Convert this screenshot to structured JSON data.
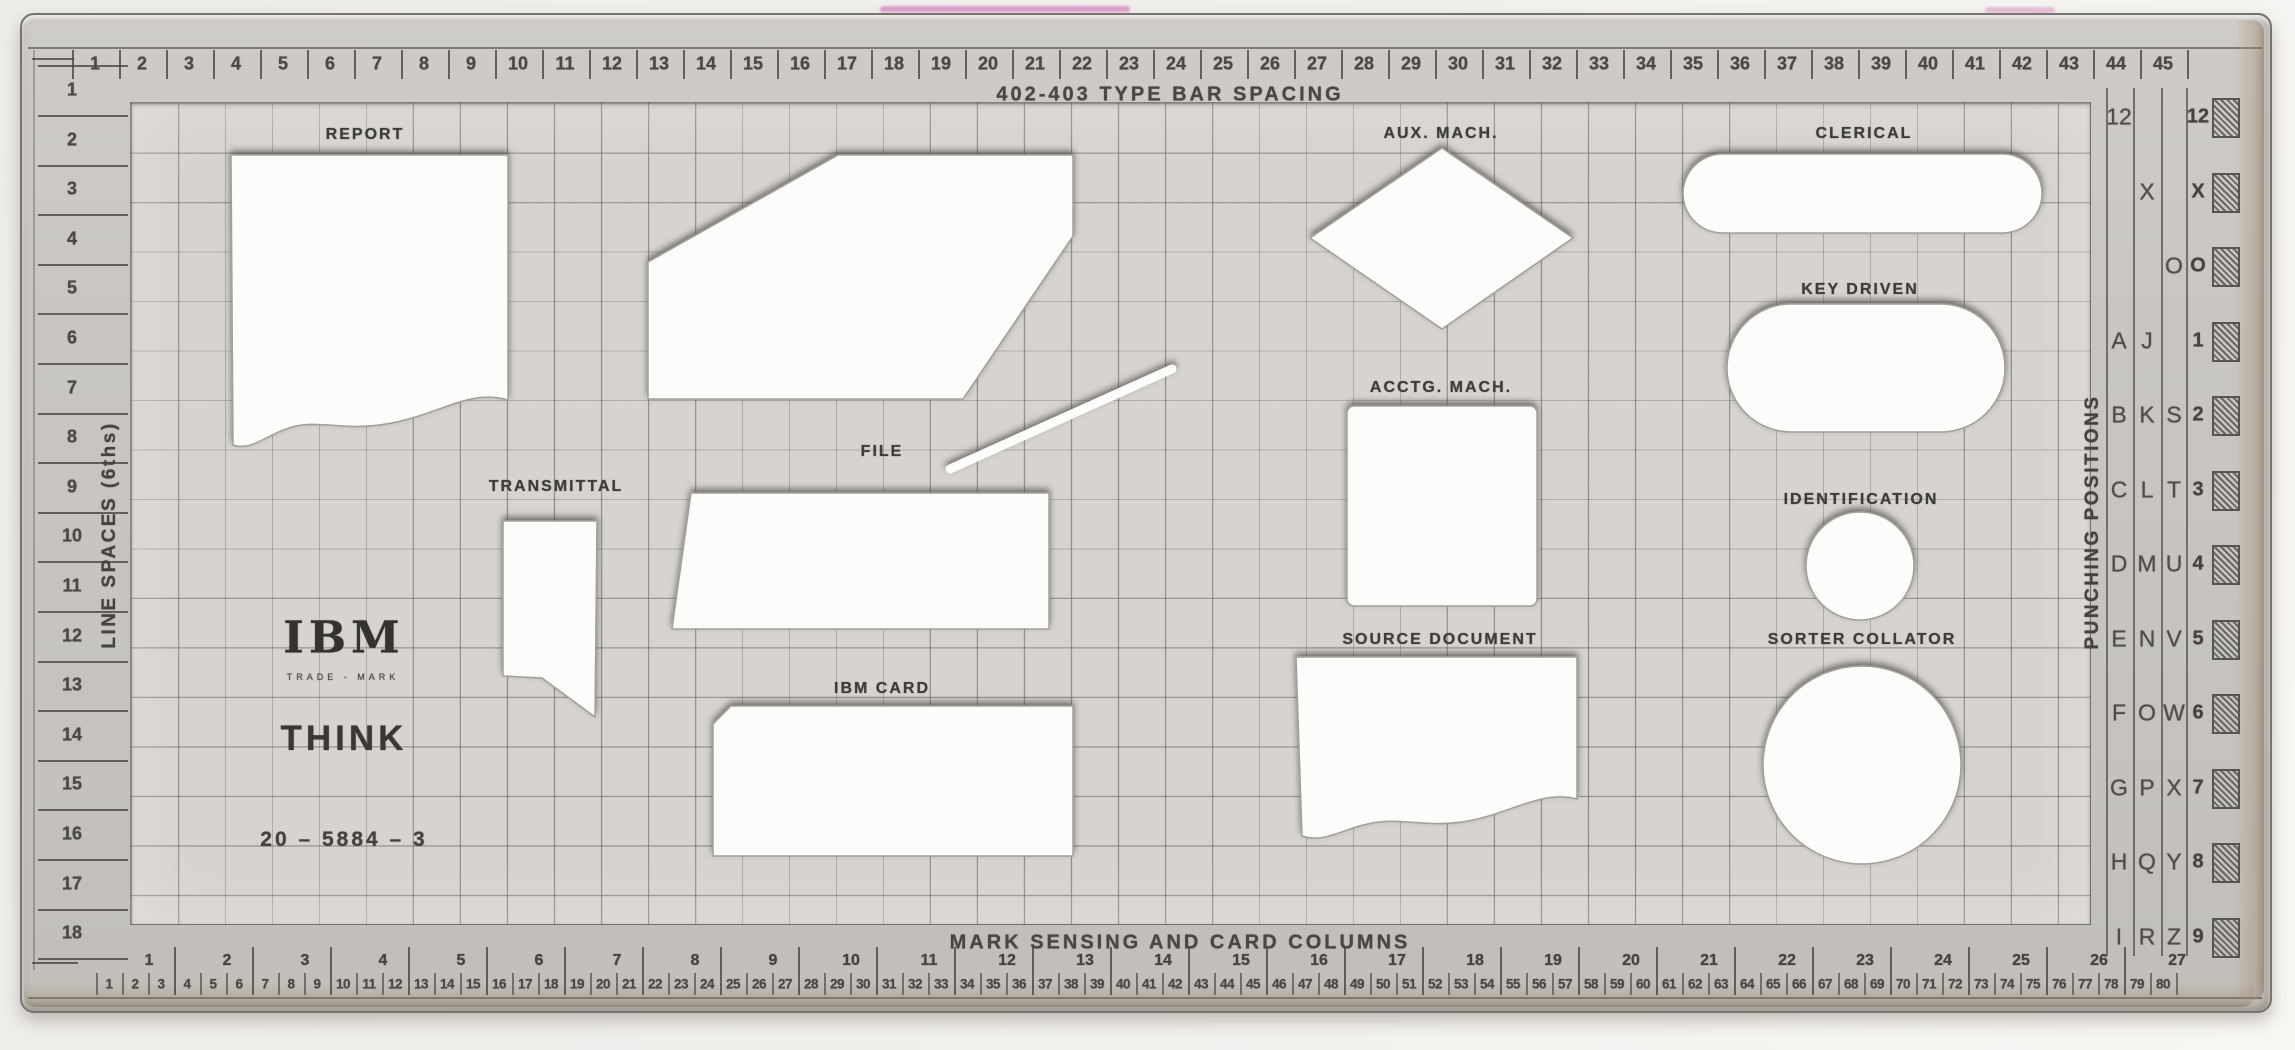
{
  "titles": {
    "top": "402-403 TYPE BAR SPACING",
    "bottom": "MARK SENSING AND CARD COLUMNS",
    "left": "LINE SPACES (6ths)",
    "right": "PUNCHING POSITIONS"
  },
  "brand": {
    "logo": "IBM",
    "trademark": "TRADE - MARK",
    "slogan": "THINK",
    "part_number": "20 – 5884 – 3"
  },
  "top_ruler": {
    "numbers": [
      1,
      2,
      3,
      4,
      5,
      6,
      7,
      8,
      9,
      10,
      11,
      12,
      13,
      14,
      15,
      16,
      17,
      18,
      19,
      20,
      21,
      22,
      23,
      24,
      25,
      26,
      27,
      28,
      29,
      30,
      31,
      32,
      33,
      34,
      35,
      36,
      37,
      38,
      39,
      40,
      41,
      42,
      43,
      44,
      45
    ]
  },
  "left_ruler": {
    "numbers": [
      1,
      2,
      3,
      4,
      5,
      6,
      7,
      8,
      9,
      10,
      11,
      12,
      13,
      14,
      15,
      16,
      17,
      18
    ]
  },
  "bottom_ruler": {
    "mark_numbers": [
      1,
      2,
      3,
      4,
      5,
      6,
      7,
      8,
      9,
      10,
      11,
      12,
      13,
      14,
      15,
      16,
      17,
      18,
      19,
      20,
      21,
      22,
      23,
      24,
      25,
      26,
      27
    ],
    "card_numbers": [
      1,
      2,
      3,
      4,
      5,
      6,
      7,
      8,
      9,
      10,
      11,
      12,
      13,
      14,
      15,
      16,
      17,
      18,
      19,
      20,
      21,
      22,
      23,
      24,
      25,
      26,
      27,
      28,
      29,
      30,
      31,
      32,
      33,
      34,
      35,
      36,
      37,
      38,
      39,
      40,
      41,
      42,
      43,
      44,
      45,
      46,
      47,
      48,
      49,
      50,
      51,
      52,
      53,
      54,
      55,
      56,
      57,
      58,
      59,
      60,
      61,
      62,
      63,
      64,
      65,
      66,
      67,
      68,
      69,
      70,
      71,
      72,
      73,
      74,
      75,
      76,
      77,
      78,
      79,
      80
    ]
  },
  "punching_positions": {
    "rows": [
      [
        "12",
        "",
        "",
        "12"
      ],
      [
        "",
        "X",
        "",
        "X"
      ],
      [
        "",
        "",
        "O",
        "O"
      ],
      [
        "A",
        "J",
        "",
        "1"
      ],
      [
        "B",
        "K",
        "S",
        "2"
      ],
      [
        "C",
        "L",
        "T",
        "3"
      ],
      [
        "D",
        "M",
        "U",
        "4"
      ],
      [
        "E",
        "N",
        "V",
        "5"
      ],
      [
        "F",
        "O",
        "W",
        "6"
      ],
      [
        "G",
        "P",
        "X",
        "7"
      ],
      [
        "H",
        "Q",
        "Y",
        "8"
      ],
      [
        "I",
        "R",
        "Z",
        "9"
      ]
    ]
  },
  "shapes": [
    {
      "label": "REPORT"
    },
    {
      "label": "FILE"
    },
    {
      "label": "TRANSMITTAL"
    },
    {
      "label": "IBM CARD"
    },
    {
      "label": "AUX. MACH."
    },
    {
      "label": "ACCTG. MACH."
    },
    {
      "label": "SOURCE DOCUMENT"
    },
    {
      "label": "CLERICAL"
    },
    {
      "label": "KEY DRIVEN"
    },
    {
      "label": "IDENTIFICATION"
    },
    {
      "label": "SORTER COLLATOR"
    }
  ],
  "colors": {
    "plastic": "#c8c5c0",
    "grid_bg": "#d7d4cf",
    "grid_line": "#5a5854",
    "cutout": "#fcfcfb",
    "stamp_text": "#403e3a",
    "hatch": "#57554f",
    "scan_bg": "#f1efec",
    "pink_artifact": "#cd5faf"
  }
}
